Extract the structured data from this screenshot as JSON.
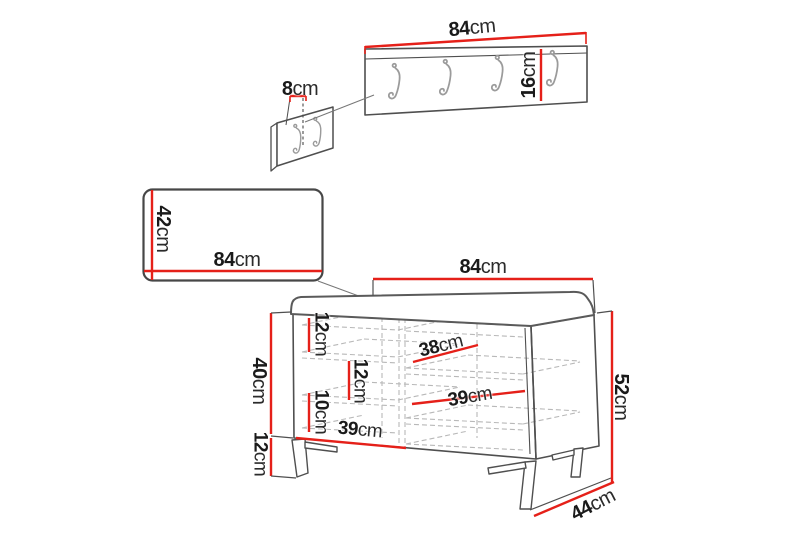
{
  "page": {
    "title": "Hallway furniture set dimension diagram"
  },
  "colors": {
    "dimension_red": "#e52019",
    "outline_gray": "#4f4f4f",
    "dashed_gray": "#b8b8b8"
  },
  "coat_rack": {
    "hooks": 4,
    "width": {
      "value": "84",
      "unit": "cm"
    },
    "height": {
      "value": "16",
      "unit": "cm"
    }
  },
  "hook_panel": {
    "hooks": 2,
    "hook_spacing": {
      "value": "8",
      "unit": "cm"
    }
  },
  "mirror": {
    "height": {
      "value": "42",
      "unit": "cm"
    },
    "width": {
      "value": "84",
      "unit": "cm"
    }
  },
  "bench": {
    "width": {
      "value": "84",
      "unit": "cm"
    },
    "total_height": {
      "value": "52",
      "unit": "cm"
    },
    "depth": {
      "value": "44",
      "unit": "cm"
    },
    "cabinet_height": {
      "value": "40",
      "unit": "cm"
    },
    "leg_height": {
      "value": "12",
      "unit": "cm"
    },
    "top_compartment_height": {
      "value": "12",
      "unit": "cm"
    },
    "middle_compartment_height": {
      "value": "12",
      "unit": "cm"
    },
    "bottom_compartment_height": {
      "value": "10",
      "unit": "cm"
    },
    "top_shelf_width": {
      "value": "38",
      "unit": "cm"
    },
    "middle_shelf_width": {
      "value": "39",
      "unit": "cm"
    },
    "bottom_shelf_width": {
      "value": "39",
      "unit": "cm"
    }
  }
}
